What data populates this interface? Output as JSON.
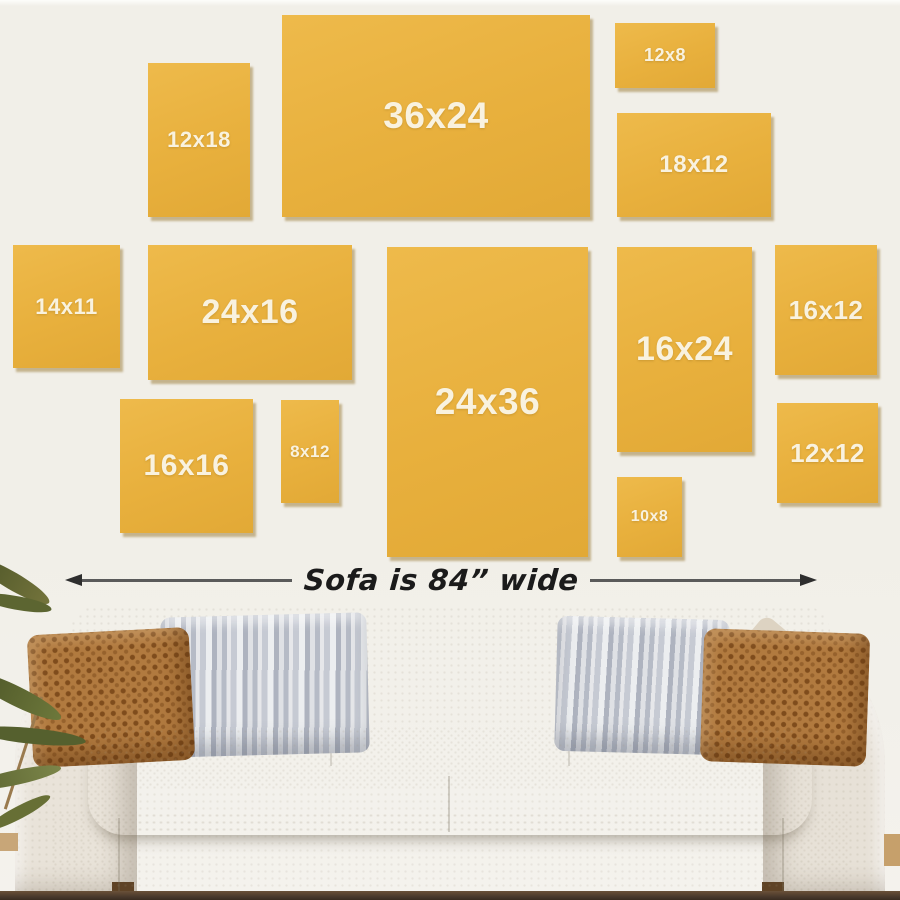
{
  "palette": {
    "wall": "#f1efe8",
    "tile_yellow": "#e9b243",
    "tile_shadow": "#9c7827",
    "tile_label": "#f9f2df",
    "arrow": "#2e2e2e",
    "arrow_text": "#1b1b1b",
    "sofa_fabric": "#e6e0d6",
    "sofa_shadow": "#cfc8ba",
    "pillow_rust": "#b1793f",
    "pillow_gray": "#c5c9d2",
    "floor": "#46362a",
    "plant_green": "#5f692f",
    "wood_foot": "#5f4326"
  },
  "wall_art": {
    "tiles": [
      {
        "label": "12x18",
        "x": 148,
        "y": 63,
        "w": 102,
        "h": 154,
        "fs": 22
      },
      {
        "label": "36x24",
        "x": 282,
        "y": 15,
        "w": 308,
        "h": 202,
        "fs": 37
      },
      {
        "label": "12x8",
        "x": 615,
        "y": 23,
        "w": 100,
        "h": 65,
        "fs": 18
      },
      {
        "label": "18x12",
        "x": 617,
        "y": 113,
        "w": 154,
        "h": 104,
        "fs": 24
      },
      {
        "label": "14x11",
        "x": 13,
        "y": 245,
        "w": 107,
        "h": 123,
        "fs": 22
      },
      {
        "label": "24x16",
        "x": 148,
        "y": 245,
        "w": 204,
        "h": 135,
        "fs": 34
      },
      {
        "label": "24x36",
        "x": 387,
        "y": 247,
        "w": 201,
        "h": 310,
        "fs": 37
      },
      {
        "label": "16x24",
        "x": 617,
        "y": 247,
        "w": 135,
        "h": 205,
        "fs": 34
      },
      {
        "label": "16x12",
        "x": 775,
        "y": 245,
        "w": 102,
        "h": 130,
        "fs": 26
      },
      {
        "label": "16x16",
        "x": 120,
        "y": 399,
        "w": 133,
        "h": 134,
        "fs": 30
      },
      {
        "label": "8x12",
        "x": 281,
        "y": 400,
        "w": 58,
        "h": 103,
        "fs": 17
      },
      {
        "label": "12x12",
        "x": 777,
        "y": 403,
        "w": 101,
        "h": 100,
        "fs": 26
      },
      {
        "label": "10x8",
        "x": 617,
        "y": 477,
        "w": 65,
        "h": 80,
        "fs": 16
      }
    ]
  },
  "sofa": {
    "width_label": "Sofa is 84” wide"
  }
}
